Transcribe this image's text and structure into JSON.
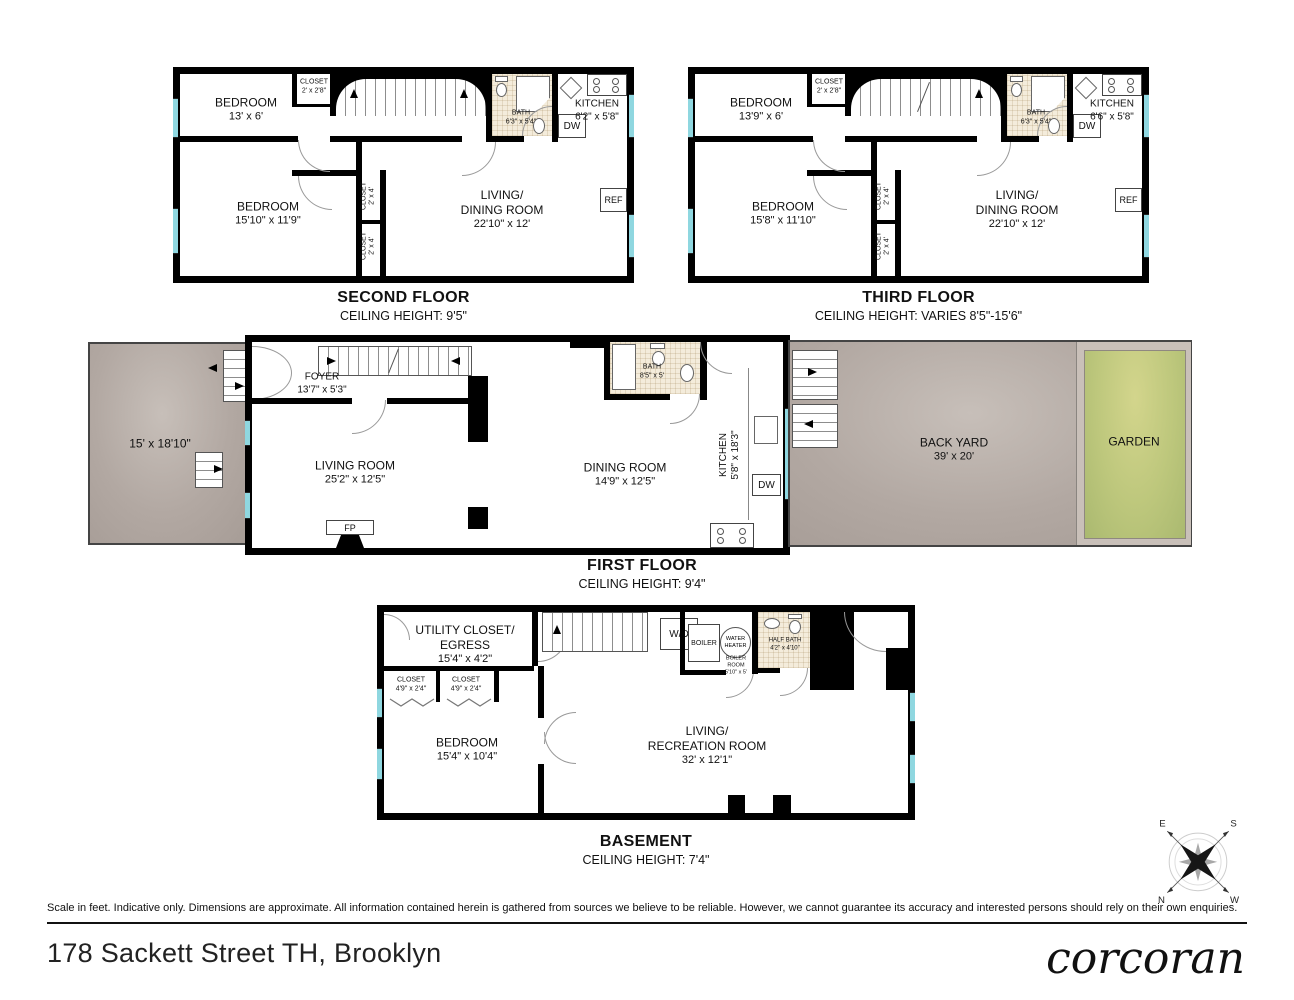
{
  "meta": {
    "address": "178 Sackett Street TH, Brooklyn",
    "brand_logo": "corcoran",
    "disclaimer": "Scale in feet. Indicative only. Dimensions are approximate. All information contained herein is gathered from sources we believe to be reliable. However, we cannot guarantee its accuracy and interested persons should rely on their own enquiries."
  },
  "compass": {
    "e": "E",
    "s": "S",
    "n": "N",
    "w": "W"
  },
  "second": {
    "title": "SECOND FLOOR",
    "subtitle": "CEILING HEIGHT: 9'5\"",
    "bedroom1_name": "BEDROOM",
    "bedroom1_dims": "13' x 6'",
    "closet1_name": "CLOSET",
    "closet1_dims": "2' x 2'8\"",
    "bath_name": "BATH",
    "bath_dims": "6'3\" x 5'4\"",
    "dw": "DW",
    "kitchen_name": "KITCHEN",
    "kitchen_dims": "6'2\" x 5'8\"",
    "ref": "REF",
    "bedroom2_name": "BEDROOM",
    "bedroom2_dims": "15'10\" x 11'9\"",
    "closet2_name": "CLOSET",
    "closet2_dims": "2' x 4'",
    "closet3_name": "CLOSET",
    "closet3_dims": "2' x 4'",
    "living_name1": "LIVING/",
    "living_name2": "DINING ROOM",
    "living_dims": "22'10\" x 12'"
  },
  "third": {
    "title": "THIRD FLOOR",
    "subtitle": "CEILING HEIGHT: VARIES 8'5\"-15'6\"",
    "bedroom1_name": "BEDROOM",
    "bedroom1_dims": "13'9\" x 6'",
    "closet1_name": "CLOSET",
    "closet1_dims": "2' x 2'8\"",
    "bath_name": "BATH",
    "bath_dims": "6'3\" x 5'4\"",
    "dw": "DW",
    "kitchen_name": "KITCHEN",
    "kitchen_dims": "6'6\" x 5'8\"",
    "ref": "REF",
    "bedroom2_name": "BEDROOM",
    "bedroom2_dims": "15'8\" x 11'10\"",
    "closet2_name": "CLOSET",
    "closet2_dims": "2' x 4'",
    "closet3_name": "CLOSET",
    "closet3_dims": "2' x 4'",
    "living_name1": "LIVING/",
    "living_name2": "DINING ROOM",
    "living_dims": "22'10\" x 12'"
  },
  "first": {
    "title": "FIRST FLOOR",
    "subtitle": "CEILING HEIGHT: 9'4\"",
    "frontyard_dims": "15' x 18'10\"",
    "foyer_name": "FOYER",
    "foyer_dims": "13'7\" x 5'3\"",
    "living_name": "LIVING ROOM",
    "living_dims": "25'2\" x 12'5\"",
    "dining_name": "DINING ROOM",
    "dining_dims": "14'9\" x 12'5\"",
    "bath_name": "BATH",
    "bath_dims": "8'5\" x 5'",
    "kitchen_name": "KITCHEN",
    "kitchen_dims": "5'8\" x 18'3\"",
    "dw": "DW",
    "fp": "FP",
    "backyard_name": "BACK YARD",
    "backyard_dims": "39' x 20'",
    "garden_name": "GARDEN"
  },
  "basement": {
    "title": "BASEMENT",
    "subtitle": "CEILING HEIGHT: 7'4\"",
    "utility_name1": "UTILITY CLOSET/",
    "utility_name2": "EGRESS",
    "utility_dims": "15'4\" x 4'2\"",
    "closet1_name": "CLOSET",
    "closet1_dims": "4'9\" x 2'4\"",
    "closet2_name": "CLOSET",
    "closet2_dims": "4'9\" x 2'4\"",
    "bedroom_name": "BEDROOM",
    "bedroom_dims": "15'4\" x 10'4\"",
    "wd": "W/D",
    "boiler": "BOILER",
    "wh1": "WATER",
    "wh2": "HEATER",
    "br1": "BOILER",
    "br2": "ROOM",
    "br3": "5'10\" x 5'",
    "halfbath_name": "HALF BATH",
    "halfbath_dims": "4'2\" x 4'10\"",
    "living_name1": "LIVING/",
    "living_name2": "RECREATION ROOM",
    "living_dims": "32' x 12'1\""
  }
}
